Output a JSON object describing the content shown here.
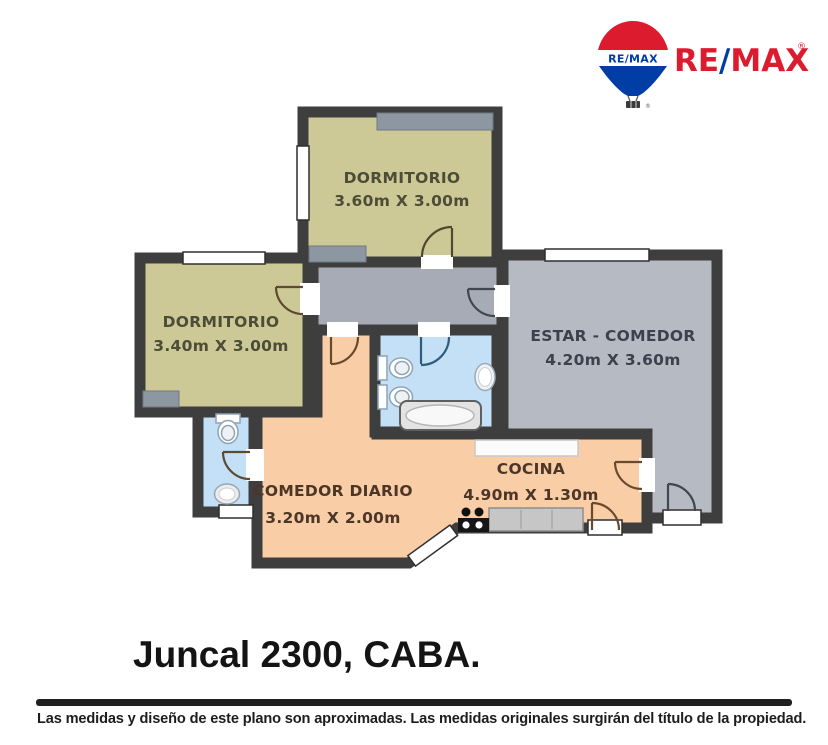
{
  "logo": {
    "balloon_label": "RE/MAX",
    "wordmark": {
      "re": "RE",
      "slash": "/",
      "max": "MAX",
      "registered": "®"
    },
    "colors": {
      "red": "#DC1C2E",
      "blue": "#003DA5"
    }
  },
  "plan": {
    "rooms": [
      {
        "name": "DORMITORIO",
        "dims": "3.60m X 3.00m"
      },
      {
        "name": "DORMITORIO",
        "dims": "3.40m X 3.00m"
      },
      {
        "name": "ESTAR - COMEDOR",
        "dims": "4.20m X 3.60m"
      },
      {
        "name": "COMEDOR DIARIO",
        "dims": "3.20m X 2.00m"
      },
      {
        "name": "COCINA",
        "dims": "4.90m X 1.30m"
      }
    ],
    "colors": {
      "wall": "#3e3e3e",
      "bedroom_fill": "#cdc997",
      "living_fill": "#b6bac3",
      "hall_fill": "#a7abb5",
      "bath_fill": "#c3e0f6",
      "dining_kitchen_fill": "#f9cda6",
      "closet_fill": "#8d97a2"
    }
  },
  "title": "Juncal 2300, CABA.",
  "disclaimer": "Las medidas y diseño de este plano son aproximadas. Las medidas originales surgirán del título de la propiedad."
}
